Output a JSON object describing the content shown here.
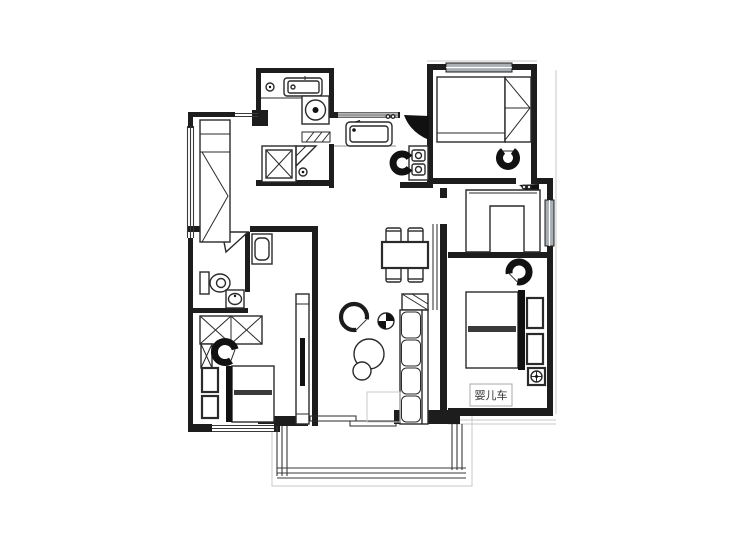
{
  "plan": {
    "type": "apartment-floor-plan",
    "labels": {
      "stroller": "婴儿车"
    },
    "colors": {
      "wall": "#1d1d1d",
      "furniture_line": "#2a2a2a",
      "window_glass": "#a9afb5",
      "light_outline": "#c9c9c9",
      "background": "#ffffff"
    },
    "furniture_icons": [
      "wardrobe-tall",
      "laundry-counter-sink",
      "washing-machine",
      "shower-stall",
      "corner-shelf",
      "floor-drain",
      "kitchen-sink",
      "stove-burners",
      "wok-pot",
      "entry-door",
      "dining-table",
      "dining-chairs",
      "bed-top-right",
      "closet-panel",
      "desk-u-cabinet",
      "window",
      "chair",
      "master-bed",
      "nightstand",
      "lamp-outlet",
      "stroller-label",
      "toilet",
      "vanity-basin",
      "dressing-table",
      "wardrobe-x",
      "bed-left",
      "tv-console",
      "armchair",
      "coffee-tables",
      "sofa",
      "plant-box",
      "pinwheel-decor",
      "balcony-glazing",
      "sliding-door",
      "door-hinges"
    ]
  }
}
